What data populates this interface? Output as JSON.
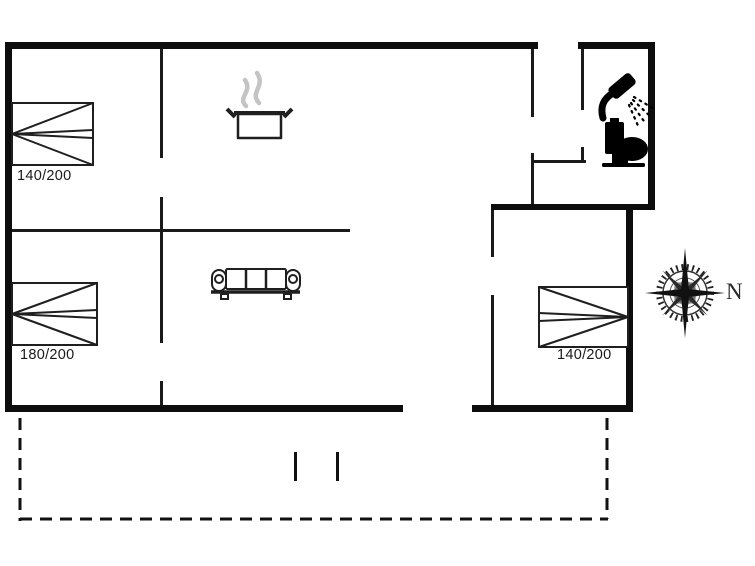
{
  "plan": {
    "type": "holiday-house-floor-plan",
    "colors": {
      "background": "#ffffff",
      "exterior_wall": "#0d0d0d",
      "interior_wall": "#1a1a1a",
      "furniture_stroke": "#1f1f1f",
      "steam": "#c4c4c4",
      "fixture_fill": "#000000",
      "compass": "#222222",
      "label_text": "#1a1a1a"
    },
    "beds": [
      {
        "id": "bed-top-left",
        "label": "140/200"
      },
      {
        "id": "bed-bottom-left",
        "label": "180/200"
      },
      {
        "id": "bed-right",
        "label": "140/200"
      }
    ],
    "compass": {
      "north_label": "N"
    },
    "icons": [
      "cooking-pot-icon",
      "steam-icon",
      "sofa-icon",
      "shower-icon",
      "toilet-icon",
      "compass-rose-icon"
    ],
    "terrace": {
      "style": "dashed-outline",
      "post_count": 2
    }
  }
}
